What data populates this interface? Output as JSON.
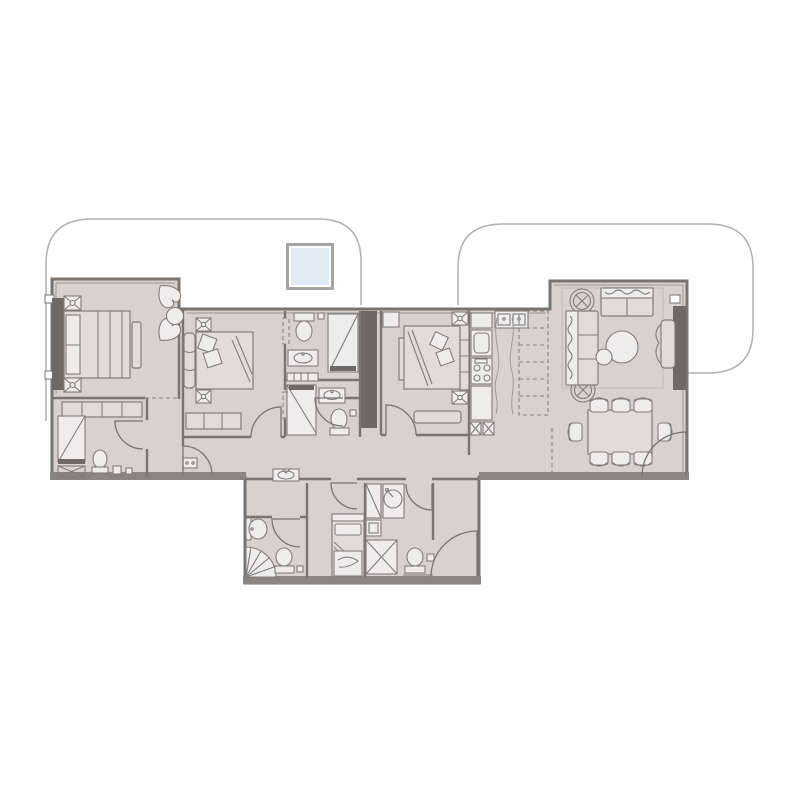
{
  "title": "apartment-floor-plan",
  "colors": {
    "background": "#ffffff",
    "floor": "#d9d1cc",
    "wall_line": "#7a746f",
    "inner_line": "#9b958f",
    "wall_dark": "#6e6964",
    "wall_edge": "#8b857f",
    "furniture_line": "#837d78",
    "furniture_fill": "#e2dbd6",
    "fixture_fill": "#efecea",
    "dashed_line": "#8a847e",
    "terrace_line": "#b3b0ad",
    "rug_line": "#bfb9b4",
    "skylight_fill": "#e3ecf4",
    "skylight_frame": "#a7a4a1"
  },
  "plan": {
    "rooms": [
      "terrace-left",
      "terrace-right",
      "master-bedroom",
      "bedroom-2",
      "bedroom-3",
      "bathroom-top",
      "bathroom-bottom",
      "ensuite-bathroom",
      "kitchen",
      "living-room",
      "dining-area",
      "hallway",
      "maid-room",
      "service-bathroom",
      "laundry",
      "wc",
      "entry-hall"
    ],
    "fixtures": [
      "skylight",
      "double-bed",
      "single-bed",
      "lounge-chairs",
      "sofa",
      "loveseat",
      "coffee-table",
      "accent-chair",
      "tv-panel",
      "dining-table-8-seats",
      "planters",
      "wardrobe",
      "stove",
      "kitchen-sink",
      "fridge",
      "washer-dryer",
      "showers",
      "toilets",
      "basins",
      "corner-shower",
      "door-swings"
    ],
    "door_count": 10,
    "skylight_present": true
  }
}
